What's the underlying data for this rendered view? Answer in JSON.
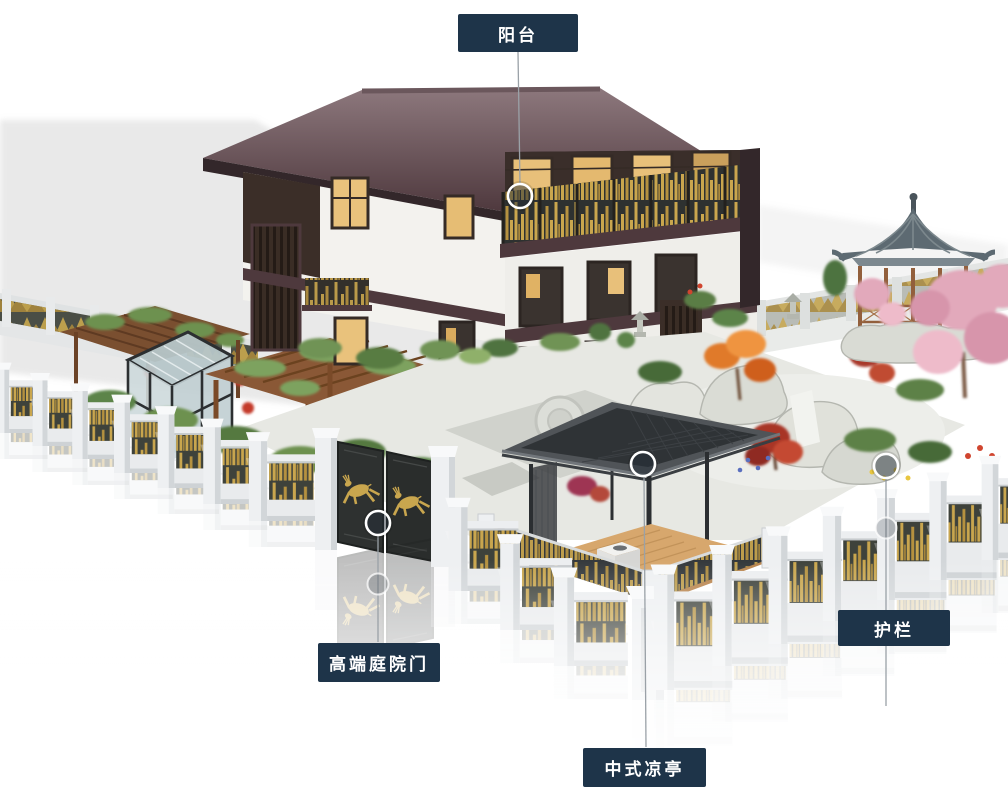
{
  "background_color": "#ffffff",
  "colors": {
    "callout_background": "#1e3449",
    "callout_text": "#ffffff",
    "leader_line": "#9aa1a7",
    "marker_ring": "#ffffff",
    "roof_maroon": "#533c41",
    "wood_trim": "#3b2e28",
    "wall_white": "#f3f2ee",
    "gold_accent": "#c9a64e",
    "fence_panel_dark": "#3e423b",
    "fence_white": "#eff1f2",
    "gazebo_roof_slate": "#5d6a72",
    "pavilion_roof_gray": "#4b5054",
    "deck_wood": "#d7a76d"
  },
  "callouts": [
    {
      "id": "balcony",
      "label": "阳台"
    },
    {
      "id": "courtyard-gate",
      "label": "高端庭院门"
    },
    {
      "id": "chinese-pavilion",
      "label": "中式凉亭"
    },
    {
      "id": "guardrail",
      "label": "护栏"
    }
  ]
}
